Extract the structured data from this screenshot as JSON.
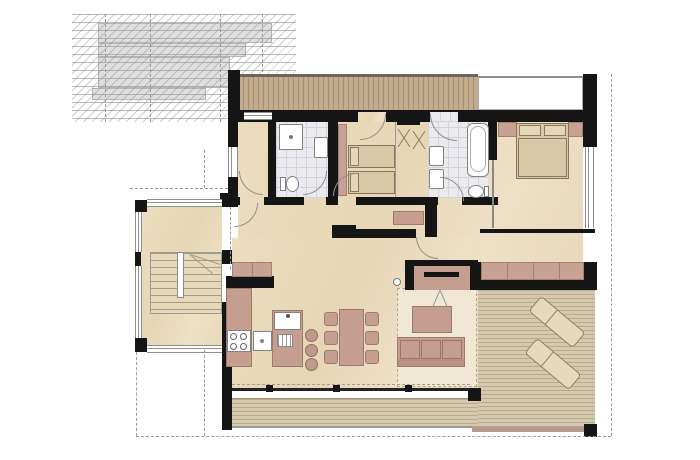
{
  "document": {
    "kind": "architectural floor plan (colored presentation drawing)",
    "visible_text": [],
    "notes": "No text labels are rendered in the image; all content is graphic."
  },
  "palette": {
    "wall": "#151515",
    "interior_floor": "#e8d9ba",
    "bathroom_tile": "#ebebef",
    "furniture_mauve": "#c59e90",
    "furniture_outline": "#9a7a6b",
    "mattress_tan": "#d8c8a7",
    "terrace_deck": "#d6caae",
    "balcony_wood": "#c3ac8e",
    "rug": "#f1e8d3",
    "neighbor_roof_gray": "#dedede",
    "overhang_dash": "#9b9b9b"
  },
  "site": {
    "adjacent_building_roof": {
      "style": "stepped gray roof with horizontal seam lines and diagonal hatching",
      "dashed_gridlines": 4
    },
    "roof_overhang_dashes": [
      "right edge",
      "bottom edge",
      "left of entry"
    ]
  },
  "rooms": [
    {
      "name": "entry-stair-hall",
      "features": [
        "u-shaped staircase",
        "windows on three sides"
      ]
    },
    {
      "name": "storage-room",
      "features": [
        "door to hallway"
      ]
    },
    {
      "name": "bathroom-small",
      "fixtures": [
        "shower",
        "washbasin",
        "toilet"
      ],
      "floor": "tile"
    },
    {
      "name": "kids-bedroom",
      "furniture": [
        "single bed",
        "single bed",
        "wardrobe strip"
      ],
      "doors": [
        "hall door",
        "balcony door"
      ]
    },
    {
      "name": "walk-in-closet",
      "furniture": [
        "clothes rail",
        "hanger cross symbols"
      ]
    },
    {
      "name": "bathroom-main",
      "fixtures": [
        "bathtub",
        "washbasin",
        "washbasin",
        "toilet"
      ],
      "floor": "tile"
    },
    {
      "name": "master-bedroom",
      "furniture": [
        "double bed",
        "two pillows",
        "headboard cabinets"
      ],
      "south_wall": "full glazing"
    },
    {
      "name": "hallway",
      "furniture": [
        "sideboard"
      ]
    },
    {
      "name": "kitchen",
      "furniture": [
        "tall cabinets",
        "wall counter",
        "cooktop 4 burners",
        "counter sink",
        "island with sink and drainer",
        "bar stools x3"
      ]
    },
    {
      "name": "dining-area",
      "furniture": [
        "dining table",
        "chairs x6"
      ]
    },
    {
      "name": "living-area",
      "furniture": [
        "sofa 3-seat",
        "coffee table",
        "rug",
        "fireplace with flue arrows"
      ]
    }
  ],
  "outdoor": {
    "balcony_top": {
      "surface": "wood planks, vertical joints"
    },
    "terrace": {
      "surface": "wood deck, horizontal boards",
      "furniture": [
        "sun lounger",
        "sun lounger",
        "built-in bench"
      ],
      "step": "low step strip at bottom edge"
    },
    "facade": {
      "south_glazing_mullions": 3,
      "skylight_void": "white rectangle at top right"
    }
  },
  "counts": {
    "single_beds": 2,
    "double_beds": 1,
    "bar_stools": 3,
    "dining_chairs": 6,
    "sun_loungers": 2,
    "bathrooms": 2
  }
}
